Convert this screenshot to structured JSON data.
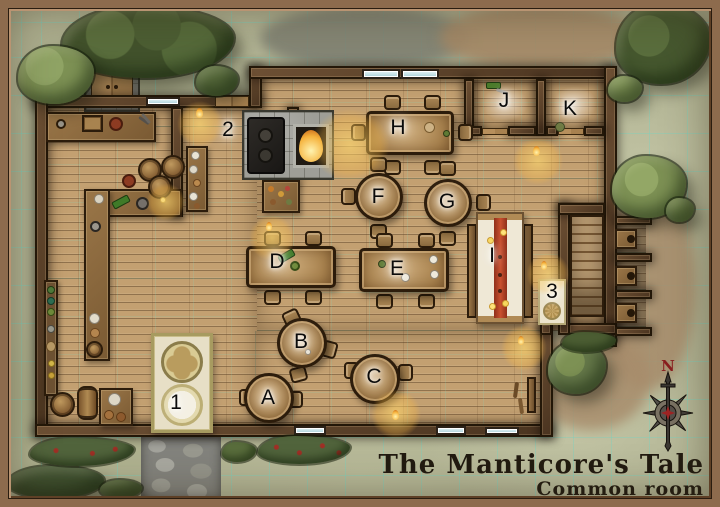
{
  "map": {
    "title": {
      "line1": "The Manticore's Tale",
      "line2": "Common room"
    },
    "compass": {
      "north": "N"
    },
    "markers": [
      {
        "label": "1",
        "x": 176,
        "y": 404
      },
      {
        "label": "2",
        "x": 228,
        "y": 131
      },
      {
        "label": "3",
        "x": 552,
        "y": 293
      },
      {
        "label": "A",
        "x": 268,
        "y": 399
      },
      {
        "label": "B",
        "x": 301,
        "y": 343
      },
      {
        "label": "C",
        "x": 374,
        "y": 378
      },
      {
        "label": "D",
        "x": 277,
        "y": 263
      },
      {
        "label": "E",
        "x": 397,
        "y": 270
      },
      {
        "label": "F",
        "x": 378,
        "y": 198
      },
      {
        "label": "G",
        "x": 447,
        "y": 203
      },
      {
        "label": "H",
        "x": 398,
        "y": 129
      },
      {
        "label": "I",
        "x": 492,
        "y": 257
      },
      {
        "label": "J",
        "x": 504,
        "y": 102
      },
      {
        "label": "K",
        "x": 570,
        "y": 110
      }
    ],
    "palette": {
      "grass": "#b2b494",
      "dirt": "#a78c6b",
      "floor": "#c3a071",
      "wall": "#5a412a",
      "grid": "#6ed6c6",
      "accent_red": "#bf4227",
      "glow": "#ffd86e",
      "stone": "#9e9e97"
    }
  }
}
